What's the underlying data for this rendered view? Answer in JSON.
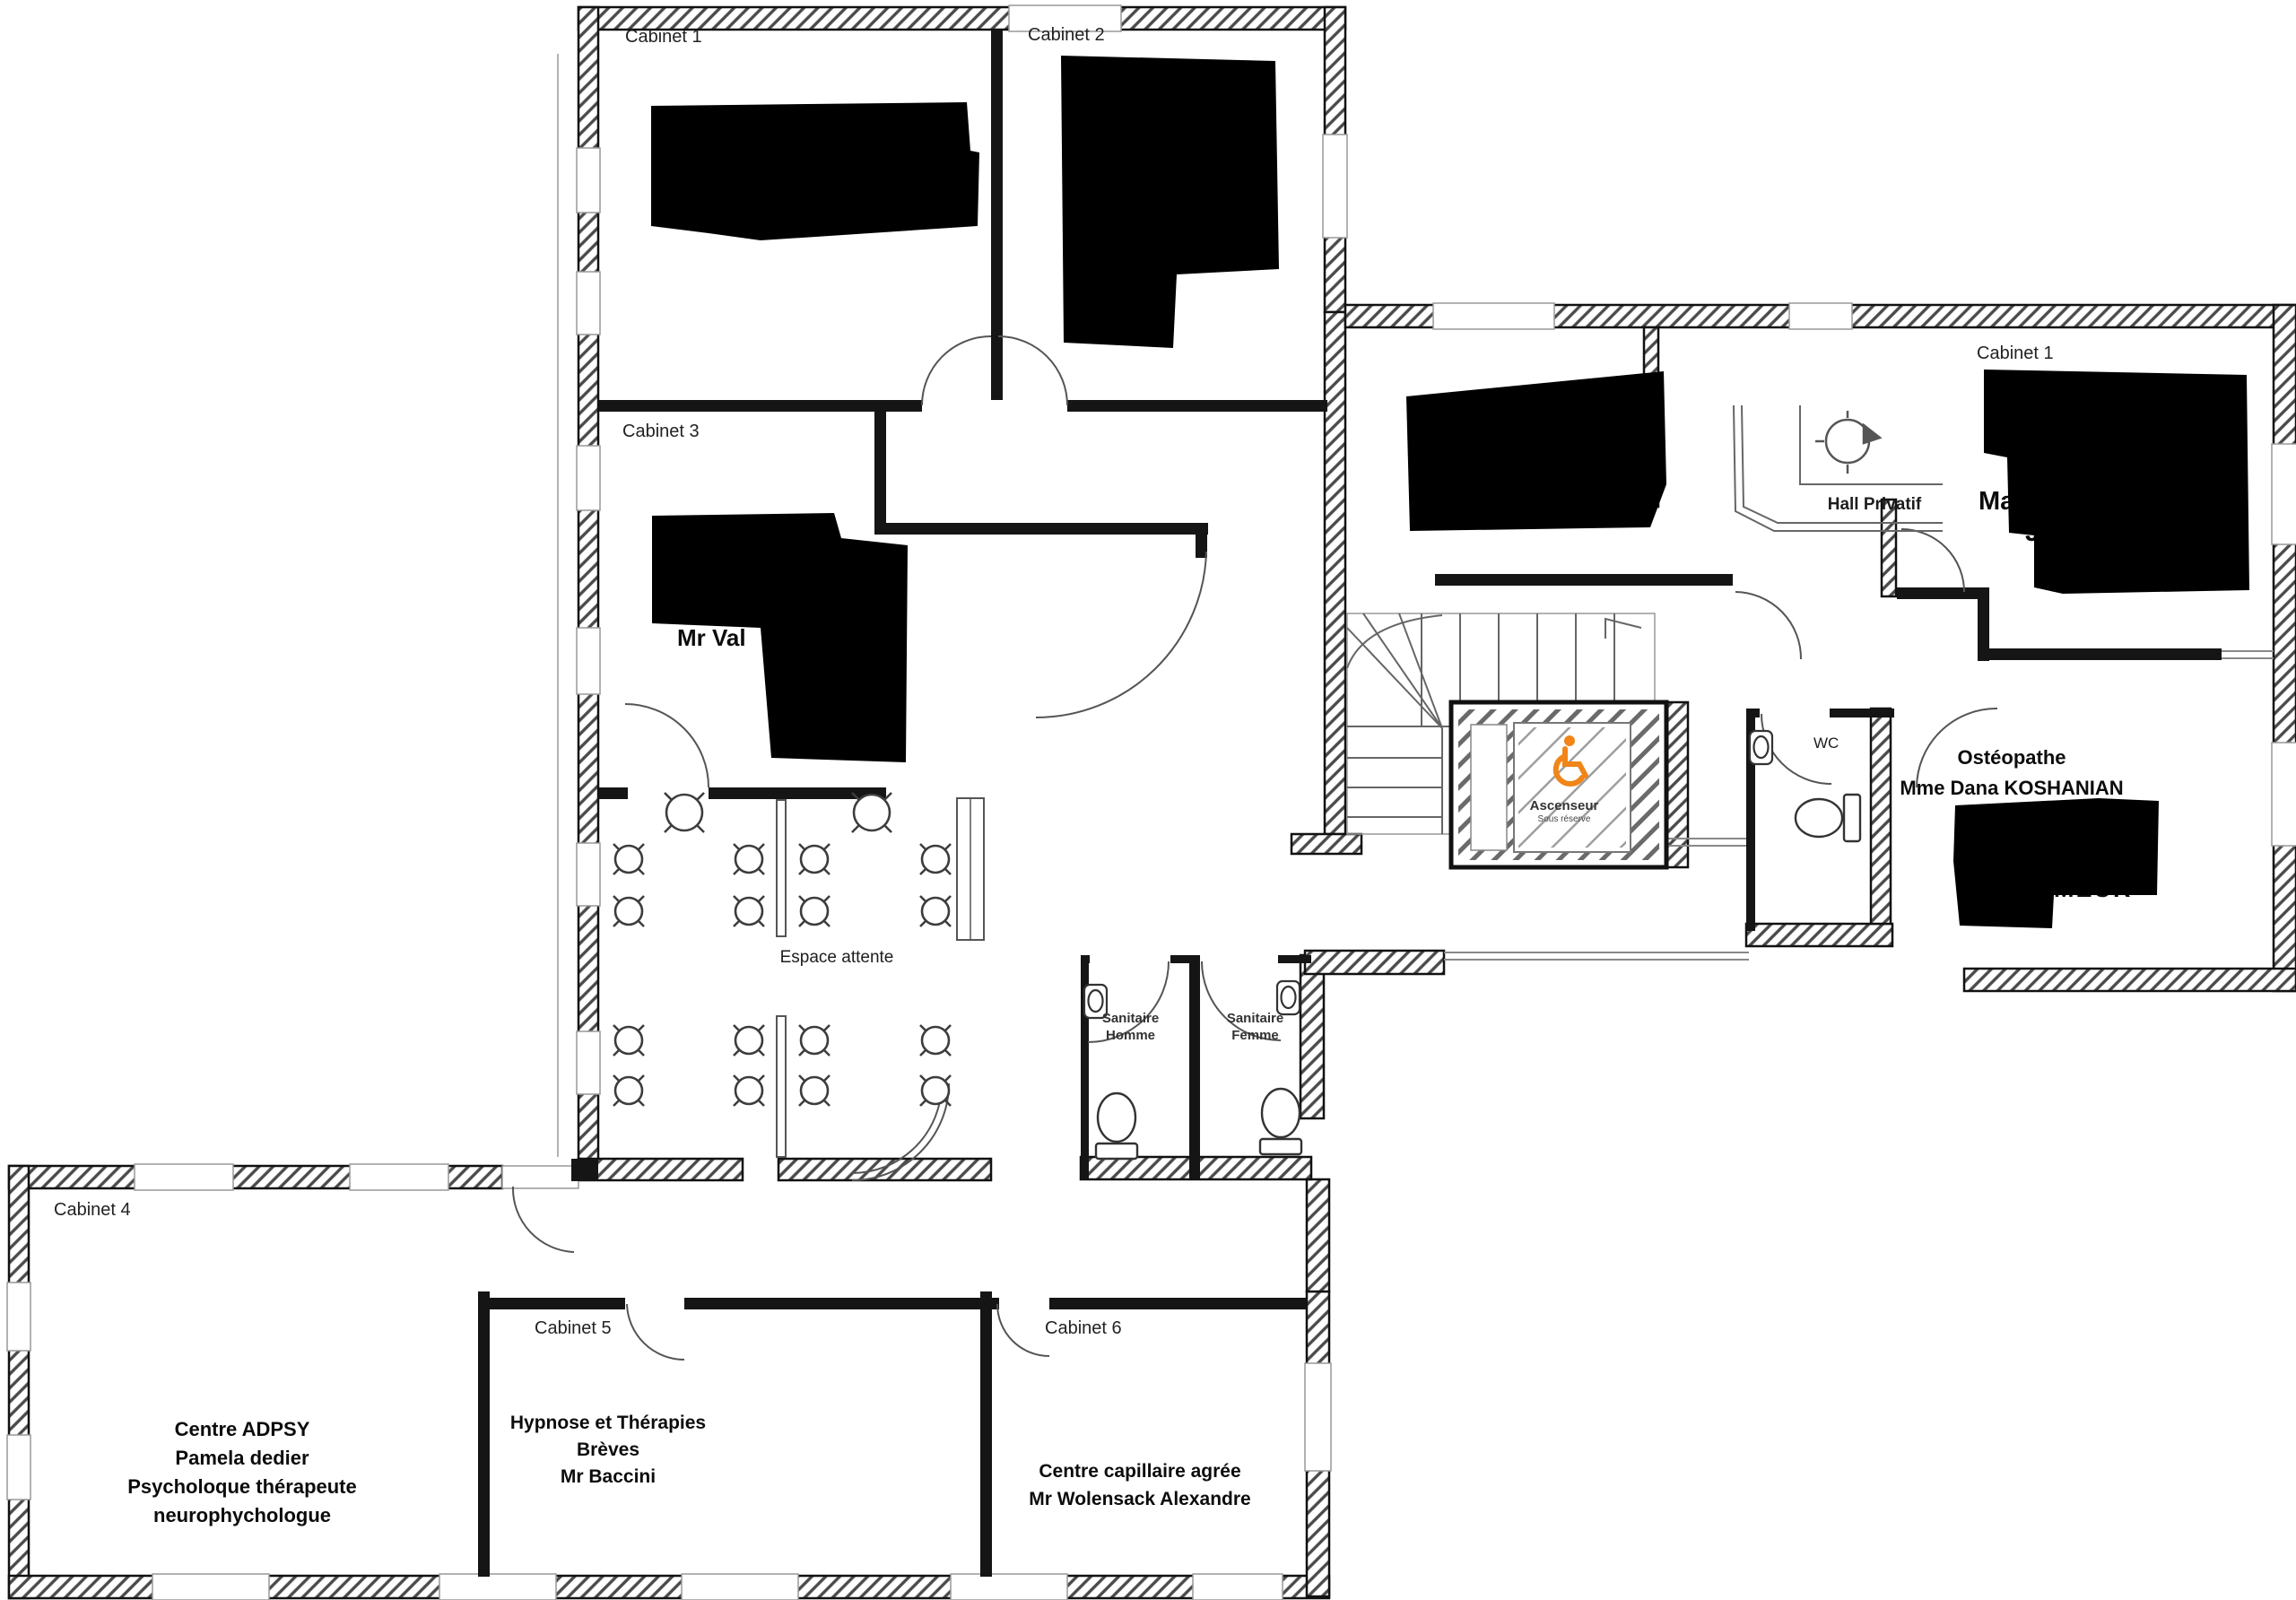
{
  "plan": {
    "accent_color": "#F08519",
    "wing_top_left": {
      "cabinet1": {
        "label": "Cabinet 1"
      },
      "cabinet2": {
        "label": "Cabinet 2"
      },
      "cabinet3": {
        "label": "Cabinet 3",
        "occupant_partial": "Mr Val"
      },
      "waiting": {
        "label": "Espace attente"
      }
    },
    "wing_right": {
      "cabinet1": {
        "label": "Cabinet 1",
        "occupant_partial_line1": "Mag",
        "occupant_partial_line2": "J"
      },
      "hall": {
        "label": "Hall Privatif"
      },
      "wc": {
        "label": "WC"
      },
      "osteopathe": {
        "title": "Ostéopathe",
        "name": "Mme Dana KOSHANIAN",
        "occupant_partial": "MEUR"
      },
      "elevator": {
        "label": "Ascenseur",
        "sublabel": "Sous réserve"
      }
    },
    "sanitaires": {
      "homme": {
        "line1": "Sanitaire",
        "line2": "Homme"
      },
      "femme": {
        "line1": "Sanitaire",
        "line2": "Femme"
      }
    },
    "wing_bottom": {
      "cabinet4": {
        "label": "Cabinet 4",
        "lines": [
          "Centre ADPSY",
          "Pamela dedier",
          "Psycholoque thérapeute",
          "neurophychologue"
        ]
      },
      "cabinet5": {
        "label": "Cabinet 5",
        "lines": [
          "Hypnose et Thérapies",
          "Brèves",
          "Mr Baccini"
        ]
      },
      "cabinet6": {
        "label": "Cabinet 6",
        "lines": [
          "Centre capillaire agrée",
          "Mr Wolensack Alexandre"
        ]
      }
    }
  }
}
